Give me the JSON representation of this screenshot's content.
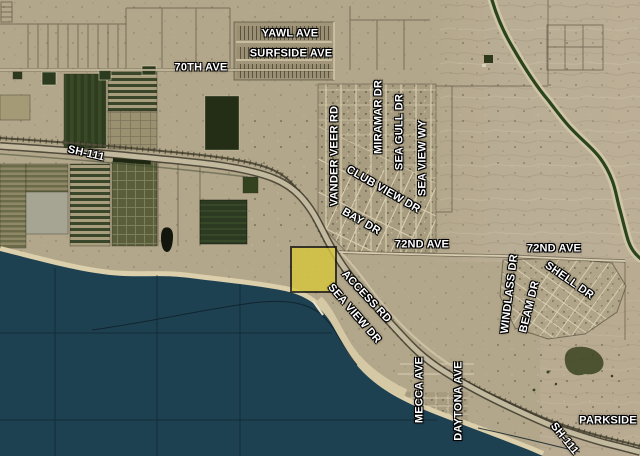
{
  "map": {
    "title": "Aerial parcel map - Salton Sea vicinity",
    "base_colors": {
      "desert": "#b3a78b",
      "desert_east": "#bbae97",
      "water": "#1e4152",
      "beach": "#dccfab",
      "field_dark_green": "#2c3a1e",
      "highway": "#c3b99f",
      "canal": "#2a451d",
      "label_text": "#ffffff",
      "label_outline": "#000000",
      "parcel_highlight_fill": "#d8c83a",
      "parcel_highlight_border": "#15150c"
    },
    "street_labels": [
      {
        "id": "yawl-ave",
        "text": "YAWL AVE",
        "x": 290,
        "y": 34,
        "r": 0
      },
      {
        "id": "surfside-ave",
        "text": "SURFSIDE AVE",
        "x": 291,
        "y": 54,
        "r": 0
      },
      {
        "id": "seventieth-ave",
        "text": "70TH AVE",
        "x": 201,
        "y": 68,
        "r": 0
      },
      {
        "id": "sh-111-west",
        "text": "SH-111",
        "x": 86,
        "y": 154,
        "r": 13
      },
      {
        "id": "vander-veer-rd",
        "text": "VANDER VEER RD",
        "x": 335,
        "y": 156,
        "r": -90
      },
      {
        "id": "miramar-dr",
        "text": "MIRAMAR DR",
        "x": 379,
        "y": 117,
        "r": -90
      },
      {
        "id": "sea-gull-dr",
        "text": "SEA GULL DR",
        "x": 400,
        "y": 132,
        "r": -90
      },
      {
        "id": "sea-view-wy",
        "text": "SEA VIEW WY",
        "x": 423,
        "y": 158,
        "r": -90
      },
      {
        "id": "club-view-dr",
        "text": "CLUB VIEW DR",
        "x": 383,
        "y": 190,
        "r": 30
      },
      {
        "id": "bay-dr",
        "text": "BAY DR",
        "x": 361,
        "y": 222,
        "r": 30
      },
      {
        "id": "seventy-second-ave-west",
        "text": "72ND AVE",
        "x": 422,
        "y": 245,
        "r": 0
      },
      {
        "id": "seventy-second-ave-east",
        "text": "72ND AVE",
        "x": 554,
        "y": 249,
        "r": 0
      },
      {
        "id": "shell-dr",
        "text": "SHELL DR",
        "x": 569,
        "y": 281,
        "r": 35
      },
      {
        "id": "windlass-dr",
        "text": "WINDLASS DR",
        "x": 510,
        "y": 294,
        "r": -83
      },
      {
        "id": "beam-dr",
        "text": "BEAM DR",
        "x": 530,
        "y": 307,
        "r": -76
      },
      {
        "id": "access-rd",
        "text": "ACCESS RD",
        "x": 366,
        "y": 297,
        "r": 47
      },
      {
        "id": "sea-view-dr",
        "text": "SEA VIEW DR",
        "x": 354,
        "y": 314,
        "r": 49
      },
      {
        "id": "mecca-ave",
        "text": "MECCA AVE",
        "x": 420,
        "y": 390,
        "r": -90
      },
      {
        "id": "daytona-ave",
        "text": "DAYTONA AVE",
        "x": 459,
        "y": 401,
        "r": -90
      },
      {
        "id": "sh-111-south",
        "text": "SH-111",
        "x": 564,
        "y": 439,
        "r": 51
      },
      {
        "id": "parkside",
        "text": "PARKSIDE",
        "x": 608,
        "y": 421,
        "r": 0
      }
    ],
    "highlighted_parcel": {
      "x": 290,
      "y": 246,
      "width": 47,
      "height": 47
    }
  }
}
